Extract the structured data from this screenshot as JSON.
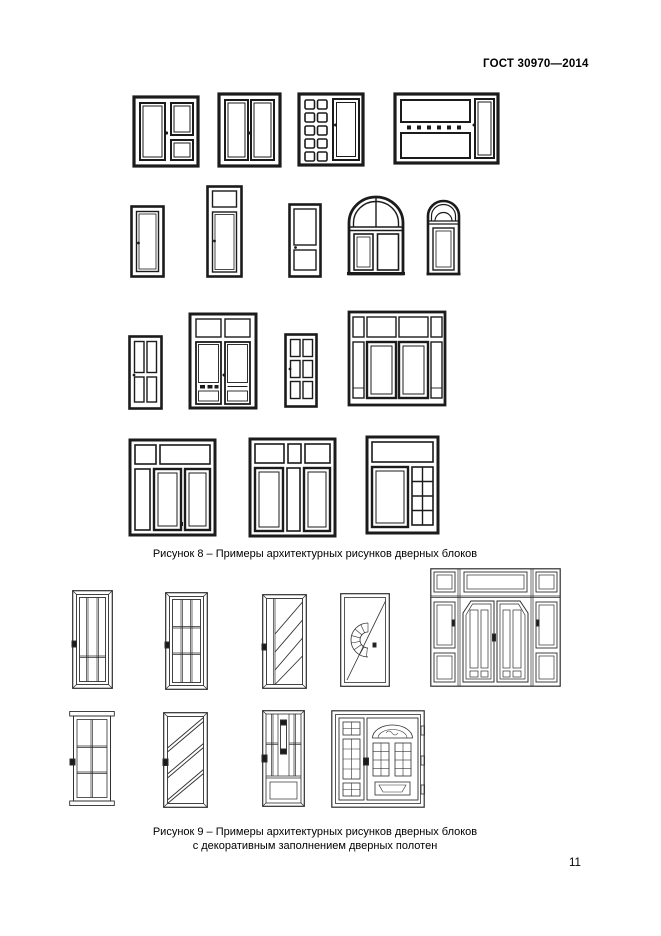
{
  "page": {
    "header": "ГОСТ 30970—2014",
    "page_number": "11"
  },
  "figure8": {
    "caption": "Рисунок 8 – Примеры архитектурных рисунков дверных блоков",
    "doors": [
      "double-door-glazed-left-leaf-two-panel-right",
      "double-door-fully-glazed",
      "door-with-ten-panel-sidelight",
      "wide-door-block-with-dentil-transom",
      "single-flush-door",
      "single-door-with-transom",
      "single-door-two-panels",
      "arched-double-door",
      "arched-single-door",
      "four-panel-door",
      "double-door-with-transom-panels",
      "six-panel-door",
      "door-block-two-leaves-sidelights-transom",
      "door-block-left-sidelight-transom",
      "door-block-center-light-transom",
      "door-block-grid-sidelight-transom"
    ]
  },
  "figure9": {
    "caption_line1": "Рисунок 9 – Примеры архитектурных рисунков дверных блоков",
    "caption_line2": "с декоративным заполнением дверных полотен",
    "doors": [
      "door-vertical-glazing-bars",
      "door-nine-pane-grid",
      "door-diagonal-glazing-bars",
      "door-fan-ornament",
      "entrance-block-double-door-sidelights-transom",
      "door-six-pane-grid-cornice",
      "door-three-diagonal-bands",
      "door-vertical-ornament",
      "entrance-door-decorative-glazing-sidelight"
    ]
  }
}
